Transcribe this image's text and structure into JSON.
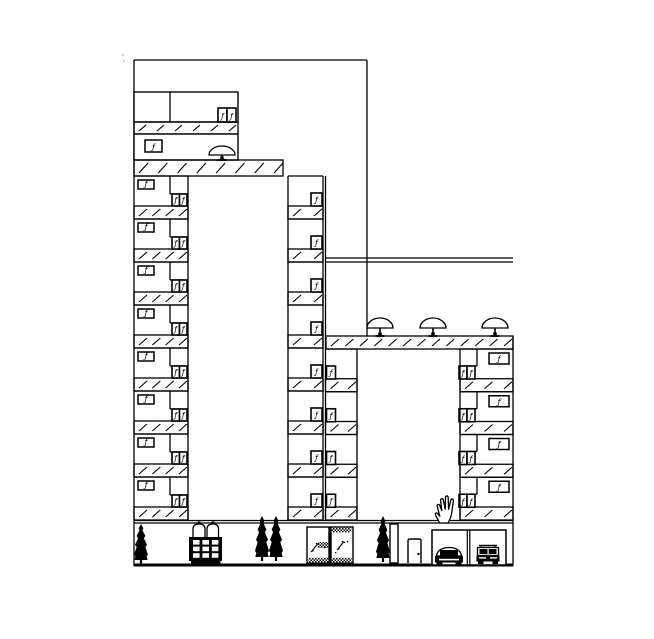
{
  "scene": {
    "title": "Residential towers elevation - CAD drawing",
    "canvas": {
      "w": 654,
      "h": 639
    },
    "colors": {
      "bg": "#ffffff",
      "ink": "#000000",
      "faint": "#c9c9c9"
    }
  },
  "glyphs": {
    "window_figure": "ƒ"
  },
  "cursor": {
    "type": "open-hand",
    "x": 433,
    "y": 494
  },
  "primitives": [
    {
      "type": "line",
      "name": "background-block-top-edge",
      "x1": 134,
      "y1": 60,
      "x2": 367,
      "y2": 60
    },
    {
      "type": "line",
      "name": "background-block-right-edge",
      "x1": 367,
      "y1": 60,
      "x2": 367,
      "y2": 336
    },
    {
      "type": "line",
      "name": "left-facade-edge",
      "x1": 134,
      "y1": 60,
      "x2": 134,
      "y2": 566
    },
    {
      "type": "rect",
      "name": "penthouse-upper-band",
      "x": 134,
      "y": 92,
      "w": 104,
      "h": 30
    },
    {
      "type": "line",
      "name": "penthouse-divider",
      "x1": 170,
      "y1": 92,
      "x2": 170,
      "y2": 122
    },
    {
      "type": "winpair",
      "name": "penthouse-window-pair",
      "x": 218,
      "y": 108,
      "w": 18,
      "h": 14
    },
    {
      "type": "hatch",
      "name": "penthouse-slab",
      "x": 134,
      "y": 122,
      "w": 104,
      "h": 12,
      "marks": 6
    },
    {
      "type": "rect",
      "name": "penthouse-lower-band",
      "x": 134,
      "y": 134,
      "w": 104,
      "h": 26
    },
    {
      "type": "figbox",
      "name": "penthouse-figure-window",
      "x": 145,
      "y": 140,
      "w": 17,
      "h": 12
    },
    {
      "type": "umbrella",
      "name": "left-tower-roof-umbrella",
      "cx": 222,
      "top": 146,
      "base": 155,
      "rx": 13,
      "stem": 160
    },
    {
      "type": "hatch",
      "name": "left-tower-roof-slab",
      "x": 134,
      "y": 160,
      "w": 149,
      "h": 16,
      "marks": 8
    },
    {
      "type": "floor-stack",
      "name": "left-tower-left-wing",
      "x": 134,
      "w": 54,
      "top": 176,
      "count": 8,
      "pitch": 43,
      "hatchH": 13,
      "hatchMarks": 4,
      "figbox": {
        "dx": 4,
        "dy": 4,
        "w": 16,
        "h": 9
      },
      "divider": {
        "dx": 36,
        "depth": 18,
        "panel": "right"
      },
      "winpair": {
        "dx": 38,
        "dy": 18,
        "w": 15,
        "h": 12
      }
    },
    {
      "type": "floor-stack",
      "name": "left-tower-right-wing",
      "x": 288,
      "w": 35,
      "top": 176,
      "count": 8,
      "pitch": 43,
      "hatchH": 13,
      "hatchMarks": 2,
      "window": {
        "dx": 23,
        "dy": 17,
        "w": 11,
        "h": 13
      }
    },
    {
      "type": "line",
      "name": "left-shaft-left-edge",
      "x1": 188,
      "y1": 176,
      "x2": 188,
      "y2": 520
    },
    {
      "type": "line",
      "name": "left-shaft-right-edge",
      "x1": 288,
      "y1": 176,
      "x2": 288,
      "y2": 520
    },
    {
      "type": "line",
      "name": "party-wall-line-a",
      "x1": 323,
      "y1": 176,
      "x2": 323,
      "y2": 520
    },
    {
      "type": "line",
      "name": "party-wall-line-b",
      "x1": 325.5,
      "y1": 176,
      "x2": 325.5,
      "y2": 520
    },
    {
      "type": "line",
      "name": "canopy-line-a",
      "x1": 326,
      "y1": 258,
      "x2": 513,
      "y2": 258
    },
    {
      "type": "line",
      "name": "canopy-line-b",
      "x1": 326,
      "y1": 262,
      "x2": 513,
      "y2": 262
    },
    {
      "type": "umbrella",
      "name": "right-roof-umbrella-1",
      "cx": 380,
      "top": 318,
      "base": 328,
      "rx": 13,
      "stem": 336
    },
    {
      "type": "umbrella",
      "name": "right-roof-umbrella-2",
      "cx": 433,
      "top": 318,
      "base": 328,
      "rx": 13,
      "stem": 336
    },
    {
      "type": "umbrella",
      "name": "right-roof-umbrella-3",
      "cx": 495,
      "top": 318,
      "base": 328,
      "rx": 13,
      "stem": 336
    },
    {
      "type": "hatch",
      "name": "right-building-roof-slab",
      "x": 326,
      "y": 336,
      "w": 187,
      "h": 13,
      "marks": 13
    },
    {
      "type": "floor-stack",
      "name": "right-building-left-wing",
      "x": 325.5,
      "w": 31.5,
      "top": 349,
      "count": 4,
      "pitch": 42.75,
      "hatchH": 13,
      "hatchMarks": 2,
      "window": {
        "dx": 1,
        "dy": 17,
        "w": 9,
        "h": 13
      }
    },
    {
      "type": "floor-stack",
      "name": "right-building-right-wing",
      "x": 460,
      "w": 53,
      "top": 349,
      "count": 4,
      "pitch": 42.75,
      "hatchH": 13,
      "hatchMarks": 3,
      "figbox": {
        "dx": 29,
        "dy": 4,
        "w": 20,
        "h": 11
      },
      "divider": {
        "dx": 17,
        "depth": 17,
        "panel": "left"
      },
      "winpair": {
        "dx": -1,
        "dy": 17,
        "w": 16,
        "h": 13
      }
    },
    {
      "type": "line",
      "name": "right-shaft-left-edge",
      "x1": 357,
      "y1": 349,
      "x2": 357,
      "y2": 520
    },
    {
      "type": "line",
      "name": "right-shaft-right-edge",
      "x1": 460,
      "y1": 349,
      "x2": 460,
      "y2": 520
    },
    {
      "type": "line",
      "name": "right-facade-edge",
      "x1": 513,
      "y1": 336,
      "x2": 513,
      "y2": 566
    },
    {
      "type": "line",
      "name": "ground-slab-line-a",
      "x1": 134,
      "y1": 520.5,
      "x2": 513,
      "y2": 520.5
    },
    {
      "type": "line",
      "name": "ground-slab-line-b",
      "x1": 134,
      "y1": 523,
      "x2": 513,
      "y2": 523
    },
    {
      "type": "line",
      "name": "base-line",
      "x1": 134,
      "y1": 565,
      "x2": 513,
      "y2": 565,
      "w": 3
    },
    {
      "type": "tree",
      "name": "cypress-tree-1",
      "cx": 141,
      "top": 524,
      "bottom": 564,
      "w": 14
    },
    {
      "type": "gate",
      "name": "entrance-gate",
      "x": 189,
      "y": 523
    },
    {
      "type": "tree",
      "name": "cypress-tree-2",
      "cx": 262,
      "top": 516,
      "bottom": 561,
      "w": 14
    },
    {
      "type": "tree",
      "name": "cypress-tree-3",
      "cx": 276,
      "top": 516,
      "bottom": 561,
      "w": 14
    },
    {
      "type": "glassdoor",
      "name": "entrance-glass-door",
      "x": 307,
      "y": 527,
      "w": 46,
      "h": 36
    },
    {
      "type": "tree",
      "name": "cypress-tree-4",
      "cx": 383,
      "top": 516,
      "bottom": 562,
      "w": 14
    },
    {
      "type": "rect",
      "name": "facade-pillar",
      "x": 390,
      "y": 524,
      "w": 8,
      "h": 39
    },
    {
      "type": "door",
      "name": "service-door",
      "x": 408,
      "y": 539,
      "w": 13,
      "h": 24
    },
    {
      "type": "garage",
      "name": "parking-garage",
      "x": 432,
      "y": 530,
      "w": 74,
      "h": 35,
      "div1": 467.3,
      "div2": 469.8
    },
    {
      "type": "car",
      "name": "parked-car-sedan",
      "variant": "sedan",
      "x": 435,
      "y": 546
    },
    {
      "type": "car",
      "name": "parked-car-suv",
      "variant": "suv",
      "x": 476,
      "y": 544
    },
    {
      "type": "dots",
      "name": "stray-plot-mark",
      "pts": [
        [
          122,
          54
        ],
        [
          123,
          60
        ]
      ]
    }
  ]
}
